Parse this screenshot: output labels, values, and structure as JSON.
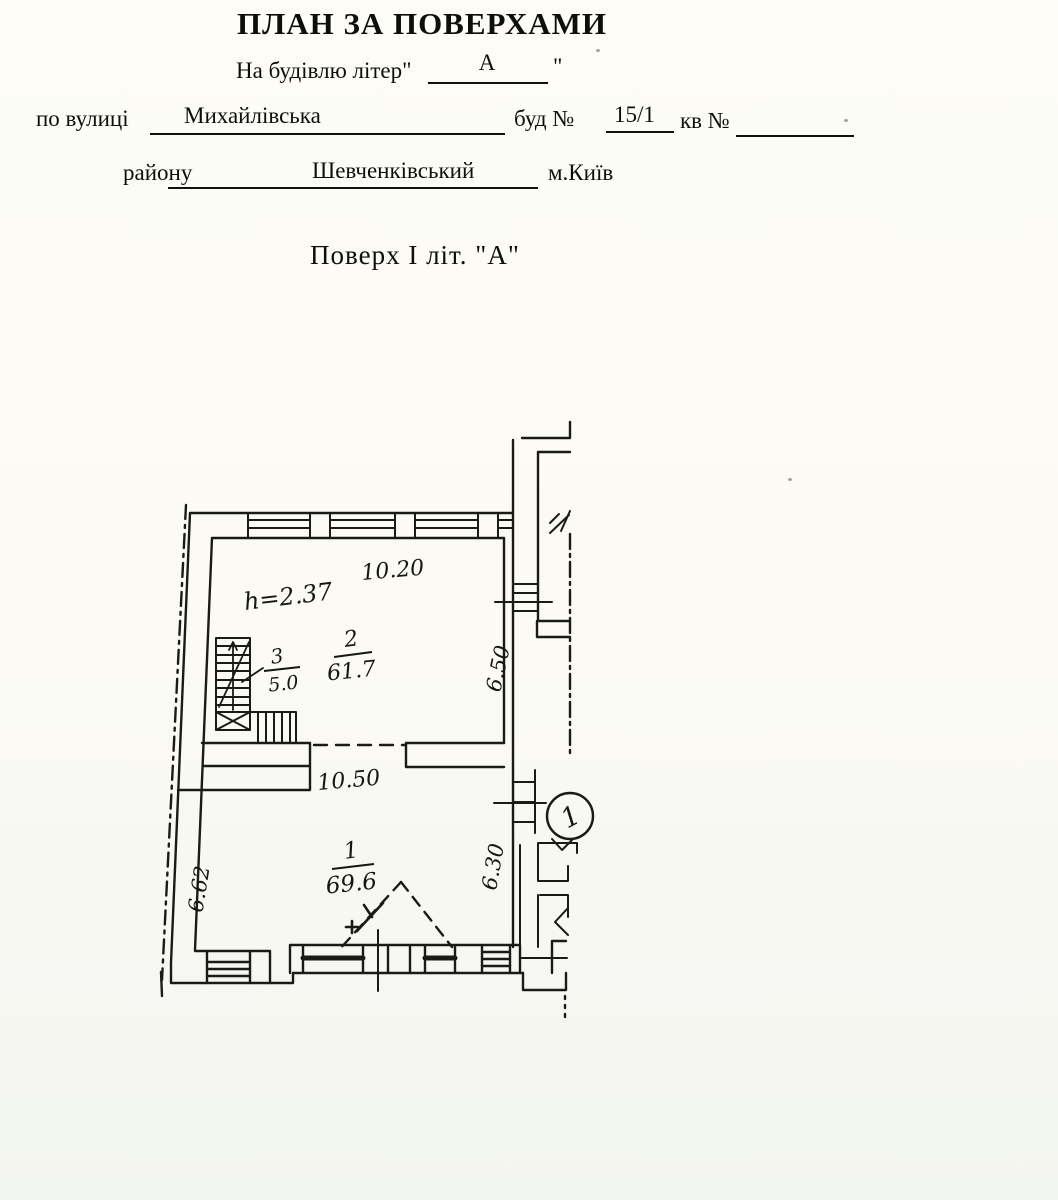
{
  "header": {
    "title": "ПЛАН ЗА ПОВЕРХАМИ",
    "building_line": {
      "label": "На будівлю літер\"",
      "value": "А",
      "close_quote": "\""
    },
    "address_line": {
      "street_label": "по вулиці",
      "street_value": "Михайлівська",
      "house_label": "буд №",
      "house_value": "15/1",
      "apt_label": "кв №"
    },
    "district_line": {
      "label": "району",
      "value": "Шевченківський",
      "city": "м.Київ"
    }
  },
  "floor_heading": "Поверх I  літ. \"А\"",
  "plan": {
    "height_note": "h=2.37",
    "dimensions": {
      "top": "10.20",
      "middle": "10.50",
      "left": "6.62",
      "right_upper": "6.50",
      "right_lower": "6.30"
    },
    "rooms": [
      {
        "number": "1",
        "area": "69.6"
      },
      {
        "number": "2",
        "area": "61.7"
      },
      {
        "number": "3",
        "area": "5.0"
      }
    ],
    "entrance_badge": "1"
  }
}
